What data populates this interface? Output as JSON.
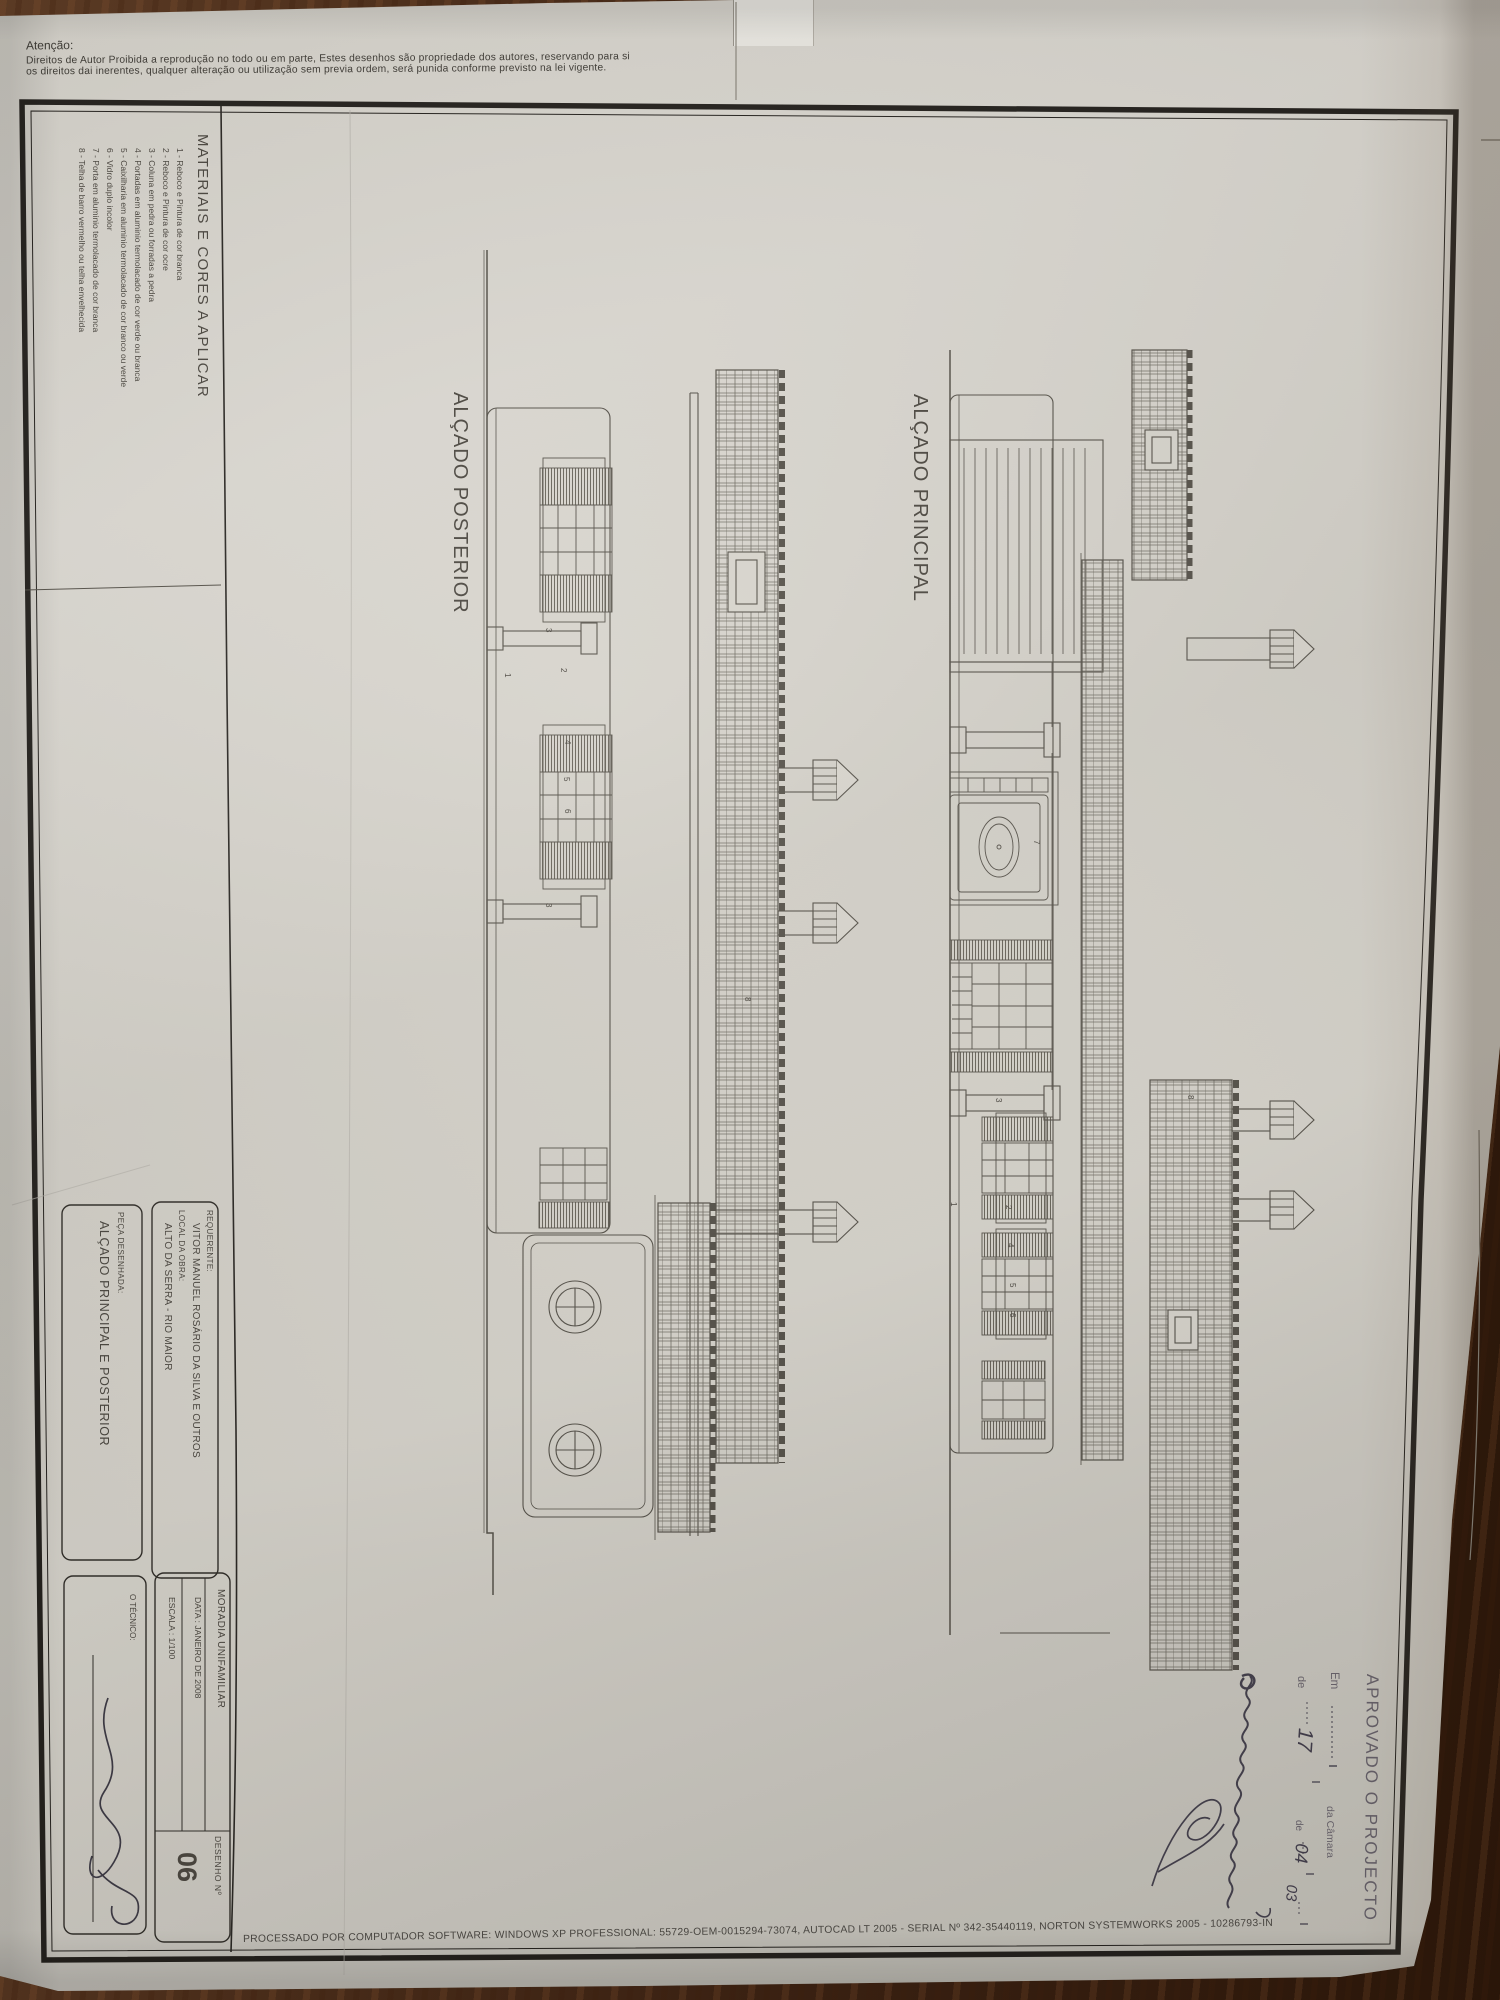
{
  "notice": {
    "title": "Atenção:",
    "line1": "Direitos de Autor Proibida a reprodução no todo ou em parte, Estes desenhos são propriedade dos autores, reservando para si",
    "line2": "os direitos dai inerentes, qualquer alteração ou utilização sem previa ordem, será punida conforme previsto na lei vigente."
  },
  "materials": {
    "title": "MATERIAIS E CORES A APLICAR",
    "items": [
      "1 - Reboco e Pintura de cor branca",
      "2 - Reboco e Pintura de cor ocre",
      "3 - Coluna em pedra ou forradas a pedra",
      "4 - Portadas em aluminio termolacado de cor verde ou branca",
      "5 - Caixilharia em aluminio termolacado de cor branco ou verde",
      "6 - Vidro duplo incolor",
      "7 - Porta em aluminio termolacado de cor branca",
      "8 - Telha de barro vermelho ou telha envelhecida"
    ]
  },
  "drawings": {
    "posterior": {
      "title": "ALÇADO POSTERIOR",
      "callouts": [
        {
          "n": "1"
        },
        {
          "n": "2"
        },
        {
          "n": "4"
        },
        {
          "n": "5"
        },
        {
          "n": "6"
        },
        {
          "n": "3"
        },
        {
          "n": "3"
        },
        {
          "n": "8"
        }
      ]
    },
    "principal": {
      "title": "ALÇADO PRINCIPAL",
      "callouts": [
        {
          "n": "7"
        },
        {
          "n": "3"
        },
        {
          "n": "1"
        },
        {
          "n": "2"
        },
        {
          "n": "4"
        },
        {
          "n": "5"
        },
        {
          "n": "6"
        },
        {
          "n": "8"
        }
      ]
    }
  },
  "stamp": {
    "approved": "APROVADO O PROJECTO",
    "em": "Em",
    "camara": "da Câmara",
    "de1": "de",
    "de2": "de",
    "day": "17",
    "month": "04",
    "year": "03"
  },
  "titleblock": {
    "requerente_label": "REQUERENTE:",
    "requerente": "VITOR MANUEL ROSÁRIO DA SILVA E OUTROS",
    "local_label": "LOCAL DA OBRA:",
    "local": "ALTO DA SERRA - RIO MAIOR",
    "moradia": "MORADIA UNIFAMILIAR",
    "data": "DATA : JANEIRO DE 2008",
    "escala": "ESCALA : 1/100",
    "peca_label": "PEÇA DESENHADA:",
    "peca": "ALÇADO PRINCIPAL E POSTERIOR",
    "tecnico_label": "O TÉCNICO:",
    "desenho_label": "DESENHO  Nº",
    "desenho_num": "06"
  },
  "footer": "PROCESSADO POR COMPUTADOR SOFTWARE: WINDOWS XP PROFESSIONAL:  55729-OEM-0015294-73074, AUTOCAD LT 2005 - SERIAL Nº  342-35440119, NORTON SYSTEMWORKS 2005 - 10286793-IN"
}
